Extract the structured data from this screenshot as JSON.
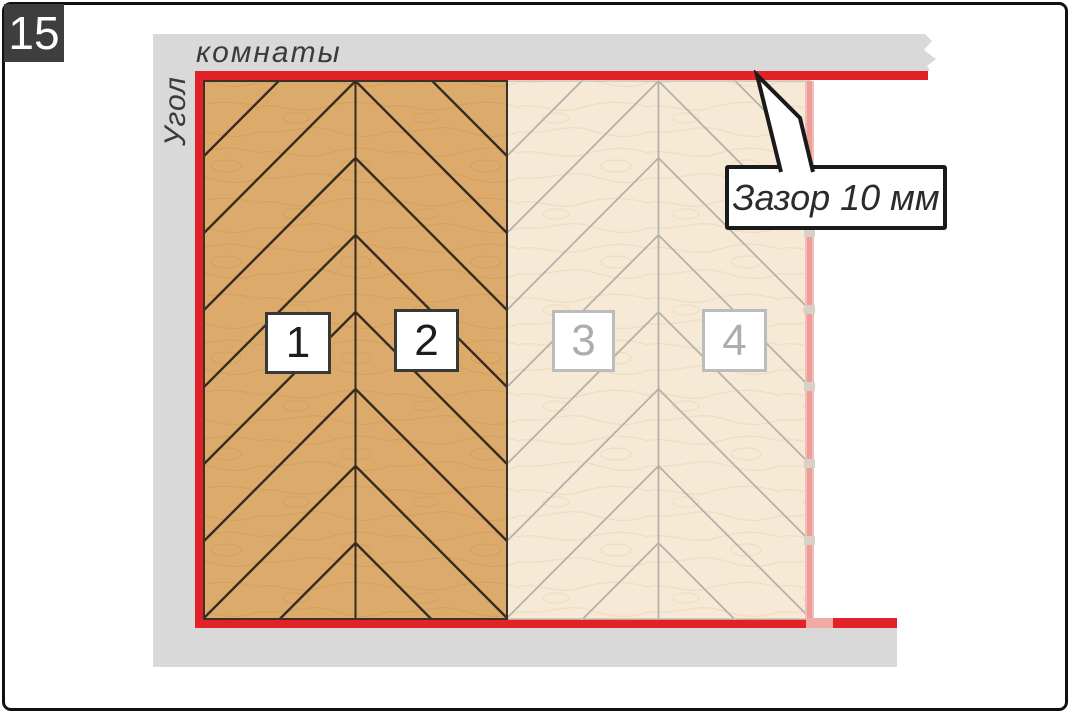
{
  "figure": {
    "step_number": "15"
  },
  "wall_labels": {
    "vertical": "Угол",
    "horizontal": "комнаты"
  },
  "callout": {
    "label": "Зазор 10 мм"
  },
  "panels": [
    {
      "label": "1",
      "state": "installed"
    },
    {
      "label": "2",
      "state": "installed"
    },
    {
      "label": "3",
      "state": "planned"
    },
    {
      "label": "4",
      "state": "planned"
    }
  ],
  "colors": {
    "accent_red": "#e32128",
    "faded_red": "#ec9f99",
    "wall_gray": "#d9d9d9",
    "installed_wood": "#dcaa6b",
    "planned_wood": "#f6ead6",
    "badge_bg": "#3e3e3e"
  }
}
